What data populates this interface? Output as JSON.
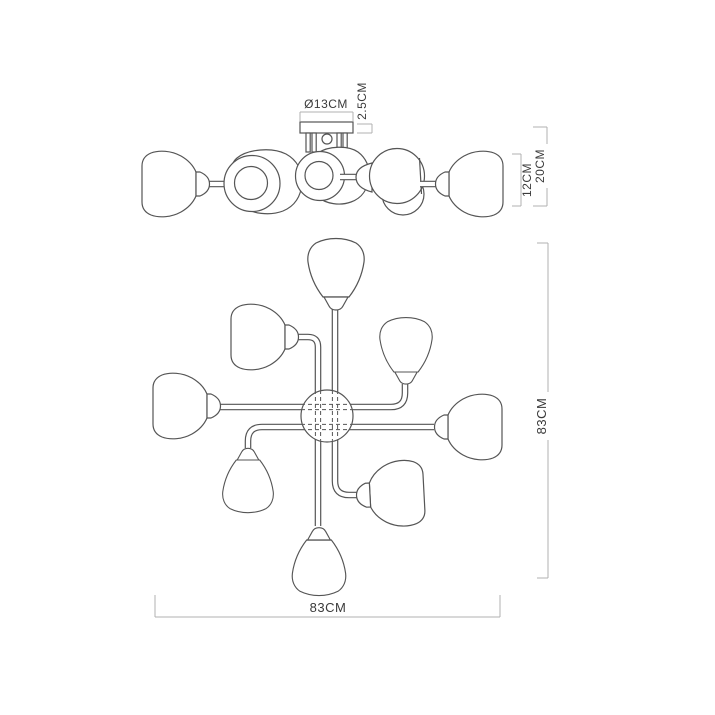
{
  "document": {
    "type": "technical-drawing",
    "subject": "8-light ceiling chandelier dimension diagram",
    "background": "#ffffff"
  },
  "side_view": {
    "labels": {
      "canopy_diameter": "Ø13CM",
      "canopy_thickness": "2.5CM",
      "shade_height": "12CM",
      "fixture_height": "20CM"
    }
  },
  "plan_view": {
    "shade_count": 8,
    "labels": {
      "width": "83CM",
      "height": "83CM"
    }
  },
  "style": {
    "line_color": "#555555",
    "dimension_line_color": "#b0b0b0",
    "text_color": "#3a3a3a"
  }
}
